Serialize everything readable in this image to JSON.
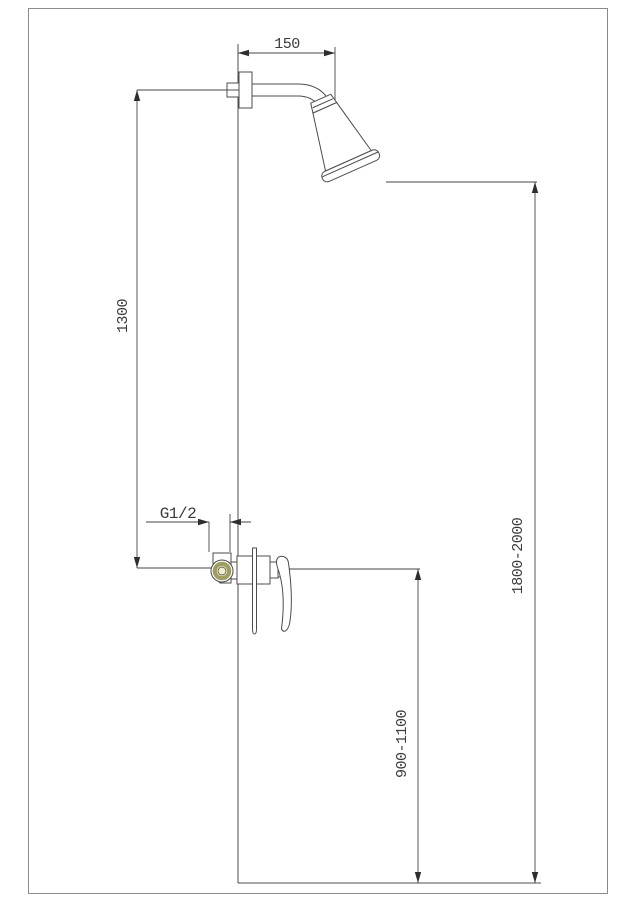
{
  "drawing": {
    "type": "technical-dimension-drawing",
    "subject": "wall-mounted shower set with mixer valve, side elevation",
    "dimensions": {
      "arm_length": "150",
      "riser_height": "1300",
      "inlet_thread": "G1/2",
      "mixer_height_range": "900-1100",
      "head_height_range": "1800-2000"
    },
    "colors": {
      "object_line": "#4c4c4c",
      "dimension_line": "#454545",
      "text": "#3b3b3b",
      "page_border": "#8a8a8a",
      "brass_fitting": "#9e9e5e",
      "brass_center": "#efecd0",
      "background": "#ffffff"
    }
  }
}
